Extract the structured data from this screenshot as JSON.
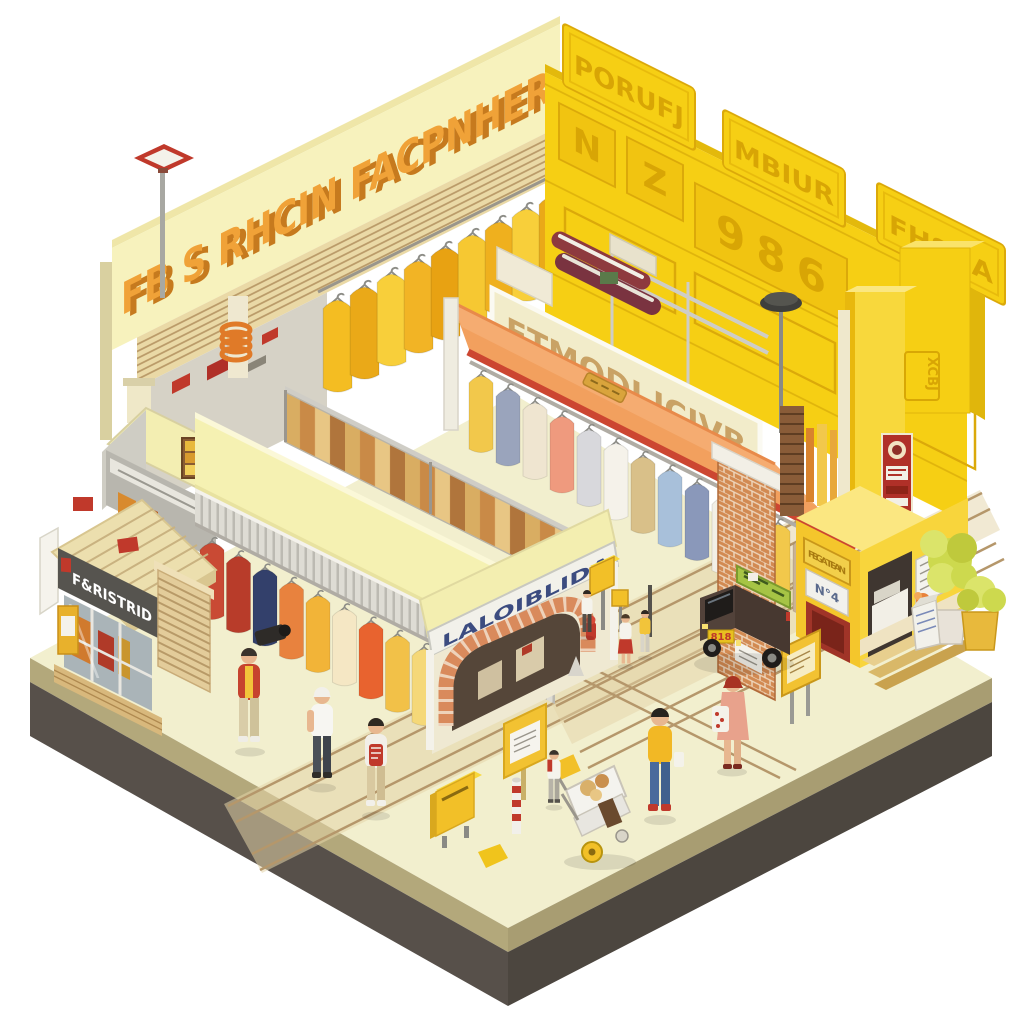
{
  "scene": {
    "background": "#ffffff",
    "signs": {
      "back_left_wall": "FB S RHCIN FACPNHER",
      "back_right_tablets": [
        "PORUFJ",
        "MBIUR",
        "FHSBA"
      ],
      "back_right_panel_n": "N",
      "back_right_panel_z": "Z",
      "back_right_panel_number": "986",
      "center_awning": "ETMODI ICIVB",
      "pavilion_arch": "LALOIBLIDA",
      "front_shop": "F&RISTRID",
      "kiosk_gold_sign": "FEGA TEAN",
      "kiosk_number_sign": "N°4",
      "tower_plate": "XCBJ",
      "van_plate": "818"
    },
    "colors": {
      "platform_top": "#f2efce",
      "platform_band": "#b3a87b",
      "platform_base": "#57504a",
      "left_wall": "#f7f2bd",
      "left_wall_letters": "#f0a238",
      "right_wall": "#f6cf14",
      "right_wall_emboss": "#d8a505",
      "orange_roof": "#f2a05e",
      "roof_trim_red": "#cc4631",
      "awning_cream": "#f2ecca",
      "awning_letters": "#c9a265",
      "pavilion_roof": "#f5f1b2",
      "arch_letters": "#3c4c80",
      "shop_sign_bg": "#56544f",
      "kiosk_yellow": "#f4c62c",
      "street_line": "#b5976b",
      "van_body": "#473830",
      "van_sign_green": "#a6c445",
      "plant_green": "#cdd94e"
    },
    "clothes": {
      "center": [
        "#f2c84b",
        "#9aa4bc",
        "#efe5d0",
        "#ef9a7e",
        "#d8d8dc",
        "#f5f2ea",
        "#d9c089",
        "#a8c0da",
        "#8a98ba",
        "#f2efe6",
        "#5c6c96",
        "#f2c84b",
        "#c9b294",
        "#e8b090"
      ],
      "pavilion": [
        "#c94a34",
        "#b83c2a",
        "#33406b",
        "#e8823e",
        "#f2b438",
        "#f5e7c4",
        "#e8632f",
        "#f2c148",
        "#f5d878",
        "#ece0bc"
      ],
      "jackets": [
        "#f4bd22",
        "#eaa918",
        "#f8cf3a",
        "#f2b425",
        "#e8a212",
        "#f6c832",
        "#efb01e",
        "#f8cf3a",
        "#eaa918"
      ]
    }
  }
}
